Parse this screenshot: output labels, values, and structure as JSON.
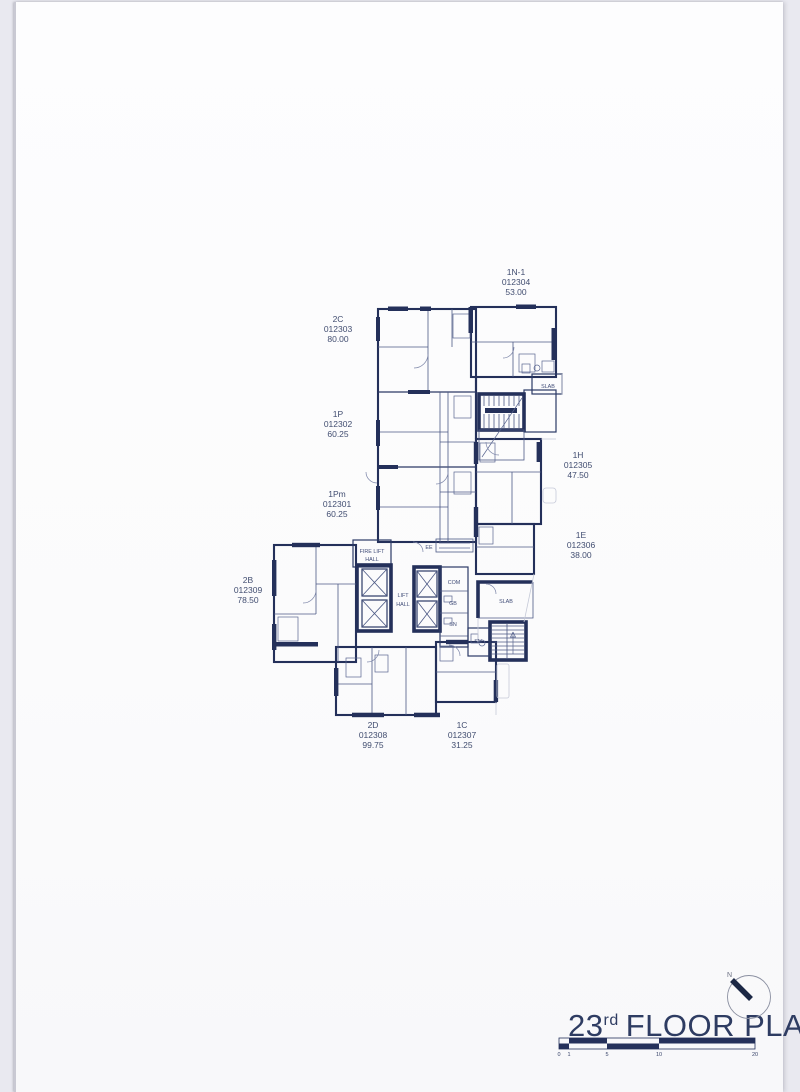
{
  "sheet": {
    "title": {
      "floor_number": "23",
      "floor_ordinal": "rd",
      "title_text": "FLOOR PLAN",
      "north_label": "N"
    },
    "scale_bar": {
      "ticks": [
        "0",
        "1",
        "5",
        "10",
        "20"
      ]
    }
  },
  "units": [
    {
      "id": "1N-1",
      "code": "012304",
      "area": "53.00"
    },
    {
      "id": "2C",
      "code": "012303",
      "area": "80.00"
    },
    {
      "id": "1P",
      "code": "012302",
      "area": "60.25"
    },
    {
      "id": "1Pm",
      "code": "012301",
      "area": "60.25"
    },
    {
      "id": "1H",
      "code": "012305",
      "area": "47.50"
    },
    {
      "id": "1E",
      "code": "012306",
      "area": "38.00"
    },
    {
      "id": "2B",
      "code": "012309",
      "area": "78.50"
    },
    {
      "id": "2D",
      "code": "012308",
      "area": "99.75"
    },
    {
      "id": "1C",
      "code": "012307",
      "area": "31.25"
    }
  ],
  "plan_labels": {
    "fire_lift_line1": "FIRE LIFT",
    "fire_lift_line2": "HALL",
    "lift_line1": "LIFT",
    "lift_line2": "HALL",
    "ee": "EE",
    "com": "COM",
    "gb": "GB",
    "sn_core": "SN",
    "sn_stair": "SN",
    "slab_upper": "SLAB",
    "slab_mid": "SLAB"
  },
  "colors": {
    "wall": "#24305a",
    "label_text": "#414d70",
    "title_text": "#2e3c62",
    "paper": "#fdfdfe",
    "backdrop": "#e9e9f0"
  }
}
